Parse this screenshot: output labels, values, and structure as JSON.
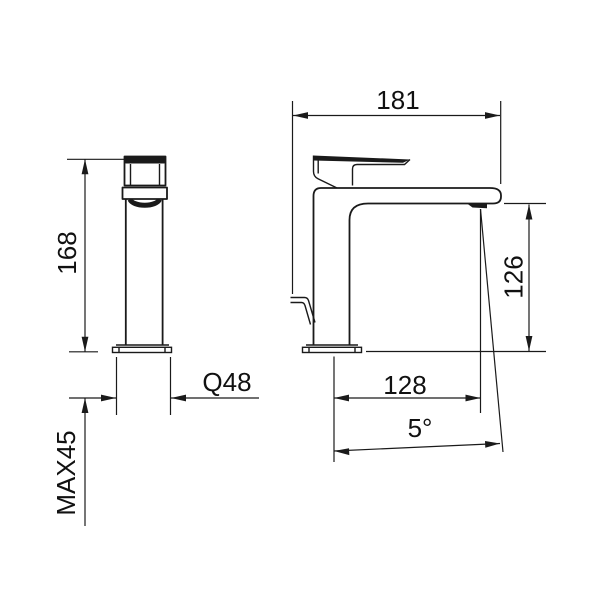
{
  "drawing": {
    "subject": "Single-lever basin mixer tap - dimensional drawing, front and side elevations",
    "background_color": "#ffffff",
    "line_color": "#1a1a1a",
    "front_view": {
      "height_label": "168",
      "base_diameter_label": "Q48",
      "max_mounting_thickness_label": "MAX45"
    },
    "side_view": {
      "overall_depth_label": "181",
      "spout_outlet_height_label": "126",
      "spout_reach_label": "128",
      "spray_angle_label": "5°"
    }
  }
}
